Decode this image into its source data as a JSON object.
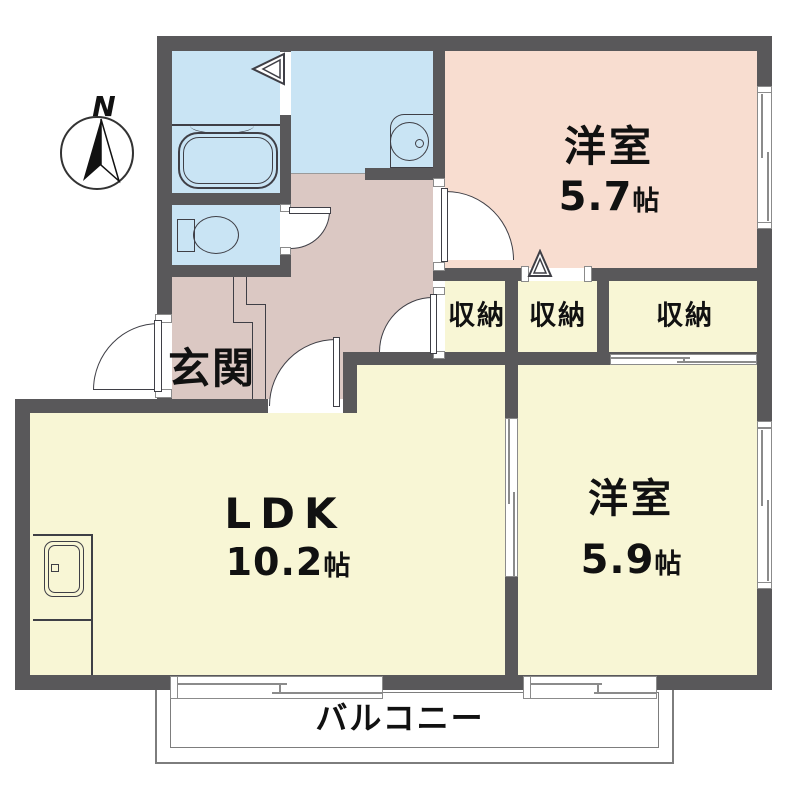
{
  "compass": {
    "label": "N"
  },
  "rooms": {
    "western_room_upper": {
      "name": "洋室",
      "size_value": "5.7",
      "size_unit": "帖"
    },
    "western_room_lower": {
      "name": "洋室",
      "size_value": "5.9",
      "size_unit": "帖"
    },
    "ldk": {
      "name": "LDK",
      "size_value": "10.2",
      "size_unit": "帖"
    },
    "entrance": {
      "name": "玄関"
    },
    "storage_1": {
      "name": "収納"
    },
    "storage_2": {
      "name": "収納"
    },
    "storage_3": {
      "name": "収納"
    },
    "balcony": {
      "name": "バルコニー"
    }
  },
  "colors": {
    "wall": "#59585a",
    "room_blue": "#c9e4f4",
    "room_salmon": "#f8ddd0",
    "room_mauve": "#dbc8c3",
    "room_yellow": "#f8f6d5",
    "line": "#3f3f46",
    "balcony_line": "#7d7d7d",
    "opening_line": "#8b8b8b",
    "text": "#111111"
  }
}
